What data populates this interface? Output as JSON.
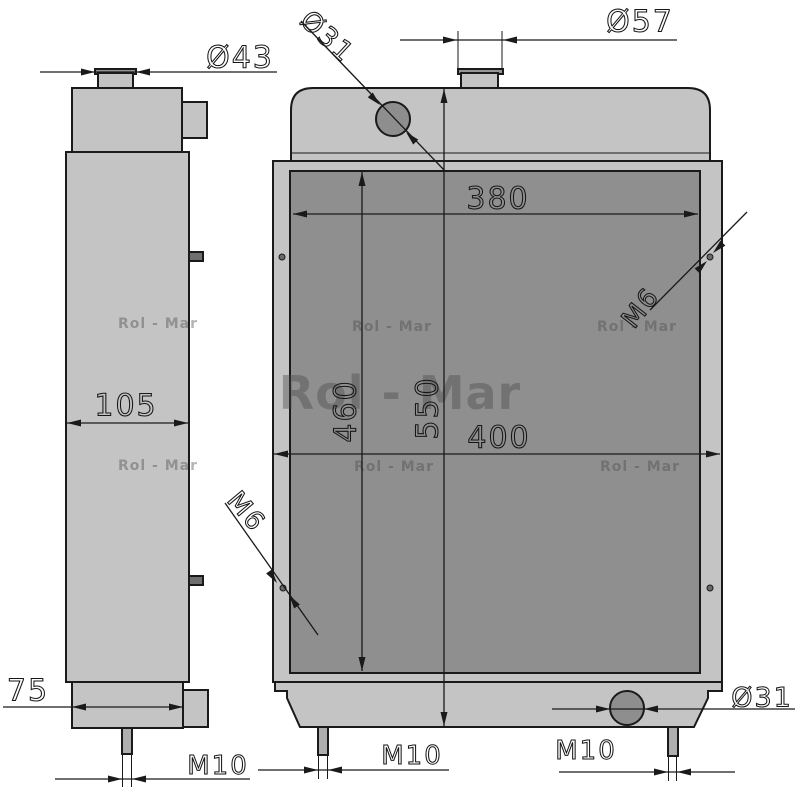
{
  "watermarks": {
    "large": "Rol - Mar",
    "small": [
      "Rol - Mar",
      "Rol - Mar",
      "Rol - Mar",
      "Rol - Mar",
      "Rol - Mar",
      "Rol - Mar"
    ]
  },
  "dimensions": {
    "side_filler_neck": "Ø43",
    "top_inlet": "Ø31",
    "filler_neck": "Ø57",
    "core_width": "380",
    "core_height": "460",
    "overall_height": "550",
    "overall_width": "400",
    "side_depth": "105",
    "side_bottom_depth": "75",
    "thread_hole_right": "M6",
    "thread_hole_left": "M6",
    "bottom_outlet": "Ø31",
    "stud_side_view": "M10",
    "stud_front_left": "M10",
    "stud_front_right": "M10"
  },
  "colors": {
    "background": "#ffffff",
    "body_fill": "#c4c4c4",
    "core_fill": "#8f8f8f",
    "flange_fill": "#969696",
    "port_fill": "#8e8e8e",
    "pin_fill": "#6f6f6f",
    "stud_fill": "#aeaeae",
    "line": "#1a1a1a",
    "watermark": "#464646"
  }
}
